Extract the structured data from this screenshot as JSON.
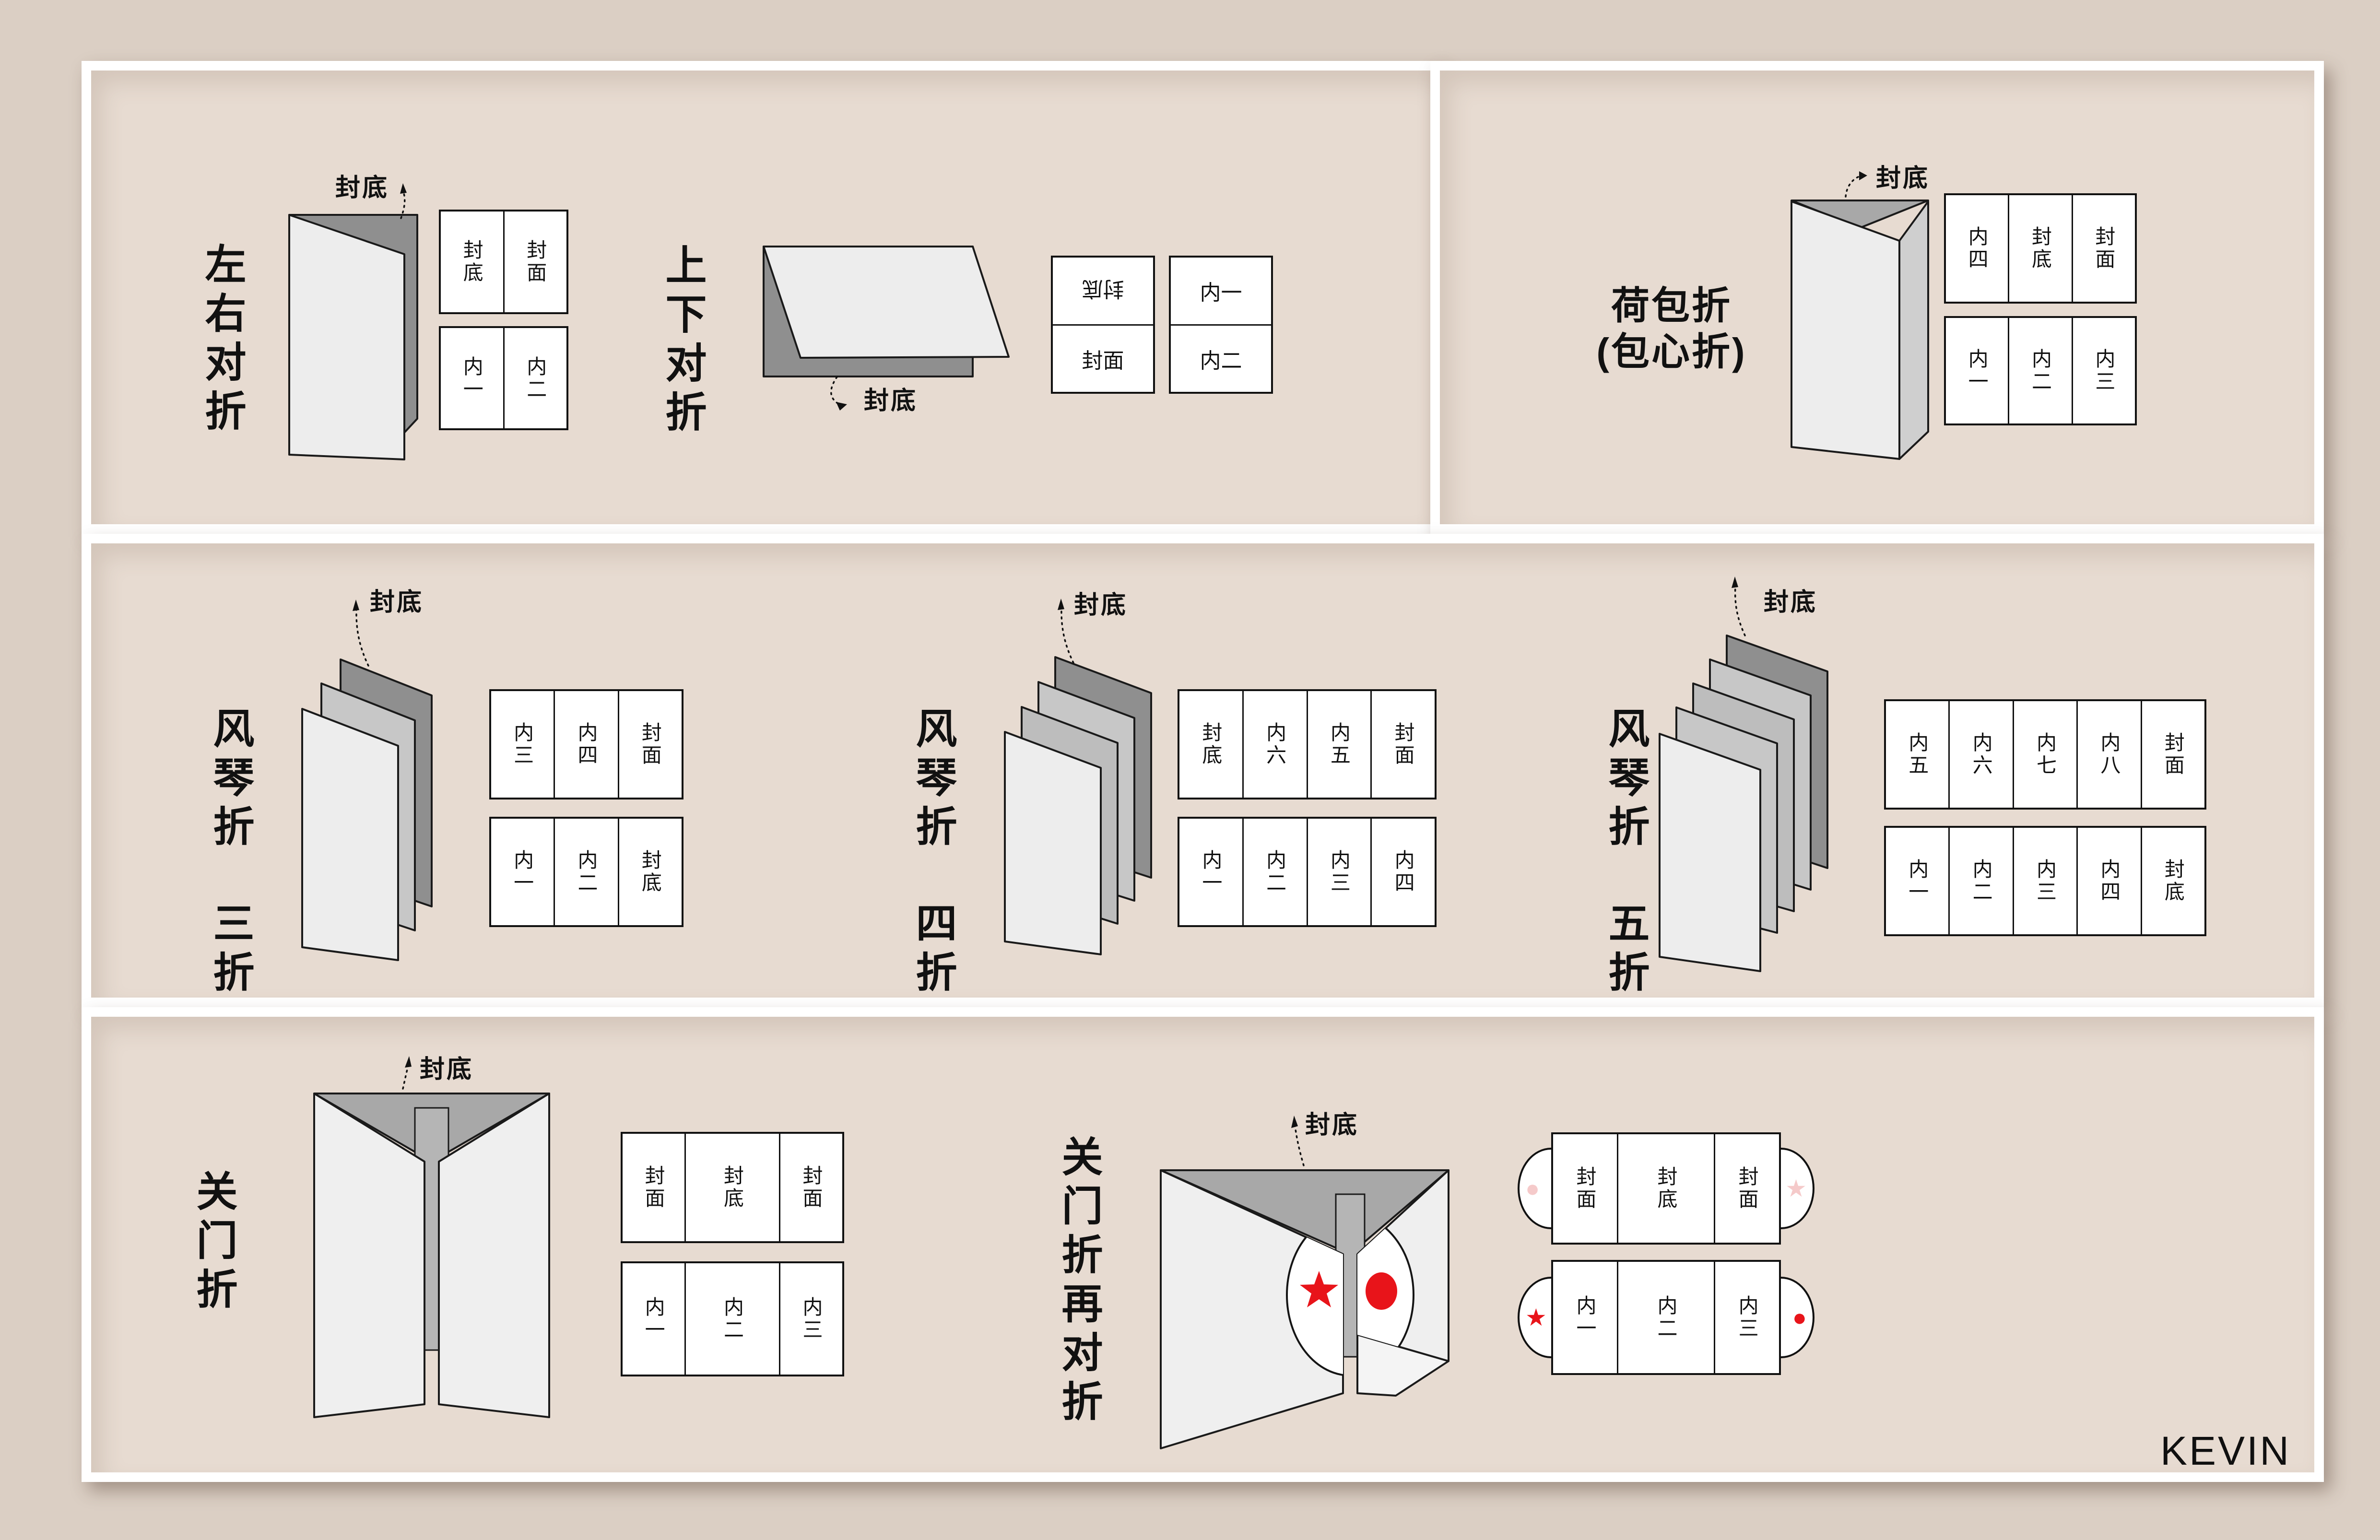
{
  "credit": "KEVIN",
  "colors": {
    "background": "#dbcfc4",
    "panel": "#e7dbd1",
    "frame": "#ffffff",
    "ink": "#111111",
    "paper_front": "#ededed",
    "paper_back": "#8f8f8f",
    "paper_mid": "#c7c7c7",
    "accent_red": "#e8141a",
    "pale_pink": "#f5caca"
  },
  "sections": [
    {
      "id": "left-right-half-fold",
      "title": "左右对折",
      "fudi": "封底",
      "face": "封面",
      "grids": [
        [
          "封底",
          "封面"
        ],
        [
          "内一",
          "内二"
        ]
      ]
    },
    {
      "id": "top-bottom-half-fold",
      "title": "上下对折",
      "fudi": "封底",
      "face": "封面",
      "columns": [
        [
          "封底",
          "封面"
        ],
        [
          "内一",
          "内二"
        ]
      ]
    },
    {
      "id": "wallet-fold",
      "title_lines": [
        "荷包折",
        "(包心折)"
      ],
      "fudi": "封底",
      "face": "封面",
      "grids": [
        [
          "内四",
          "封底",
          "封面"
        ],
        [
          "内一",
          "内二",
          "内三"
        ]
      ]
    },
    {
      "id": "accordion-3-fold",
      "title_lines": [
        "风琴折",
        "三折"
      ],
      "fudi": "封底",
      "face": "封面",
      "grids": [
        [
          "内三",
          "内四",
          "封面"
        ],
        [
          "内一",
          "内二",
          "封底"
        ]
      ]
    },
    {
      "id": "accordion-4-fold",
      "title_lines": [
        "风琴折",
        "四折"
      ],
      "fudi": "封底",
      "face": "封面",
      "grids": [
        [
          "封底",
          "内六",
          "内五",
          "封面"
        ],
        [
          "内一",
          "内二",
          "内三",
          "内四"
        ]
      ]
    },
    {
      "id": "accordion-5-fold",
      "title_lines": [
        "风琴折",
        "五折"
      ],
      "fudi": "封底",
      "face": "封面",
      "grids": [
        [
          "内五",
          "内六",
          "内七",
          "内八",
          "封面"
        ],
        [
          "内一",
          "内二",
          "内三",
          "内四",
          "封底"
        ]
      ]
    },
    {
      "id": "gate-fold",
      "title": "关门折",
      "fudi": "封底",
      "faces": [
        "封面",
        "封面"
      ],
      "grids": [
        [
          "封面",
          "封底",
          "封面"
        ],
        [
          "内一",
          "内二",
          "内三"
        ]
      ]
    },
    {
      "id": "gate-fold-plus-half-fold",
      "title": "关门折再对折",
      "fudi": "封底",
      "faces": [
        "封面",
        "封面"
      ],
      "marks": {
        "star": "★",
        "dot": "●"
      },
      "grids": [
        [
          "封面",
          "封底",
          "封面"
        ],
        [
          "内一",
          "内二",
          "内三"
        ]
      ]
    }
  ]
}
